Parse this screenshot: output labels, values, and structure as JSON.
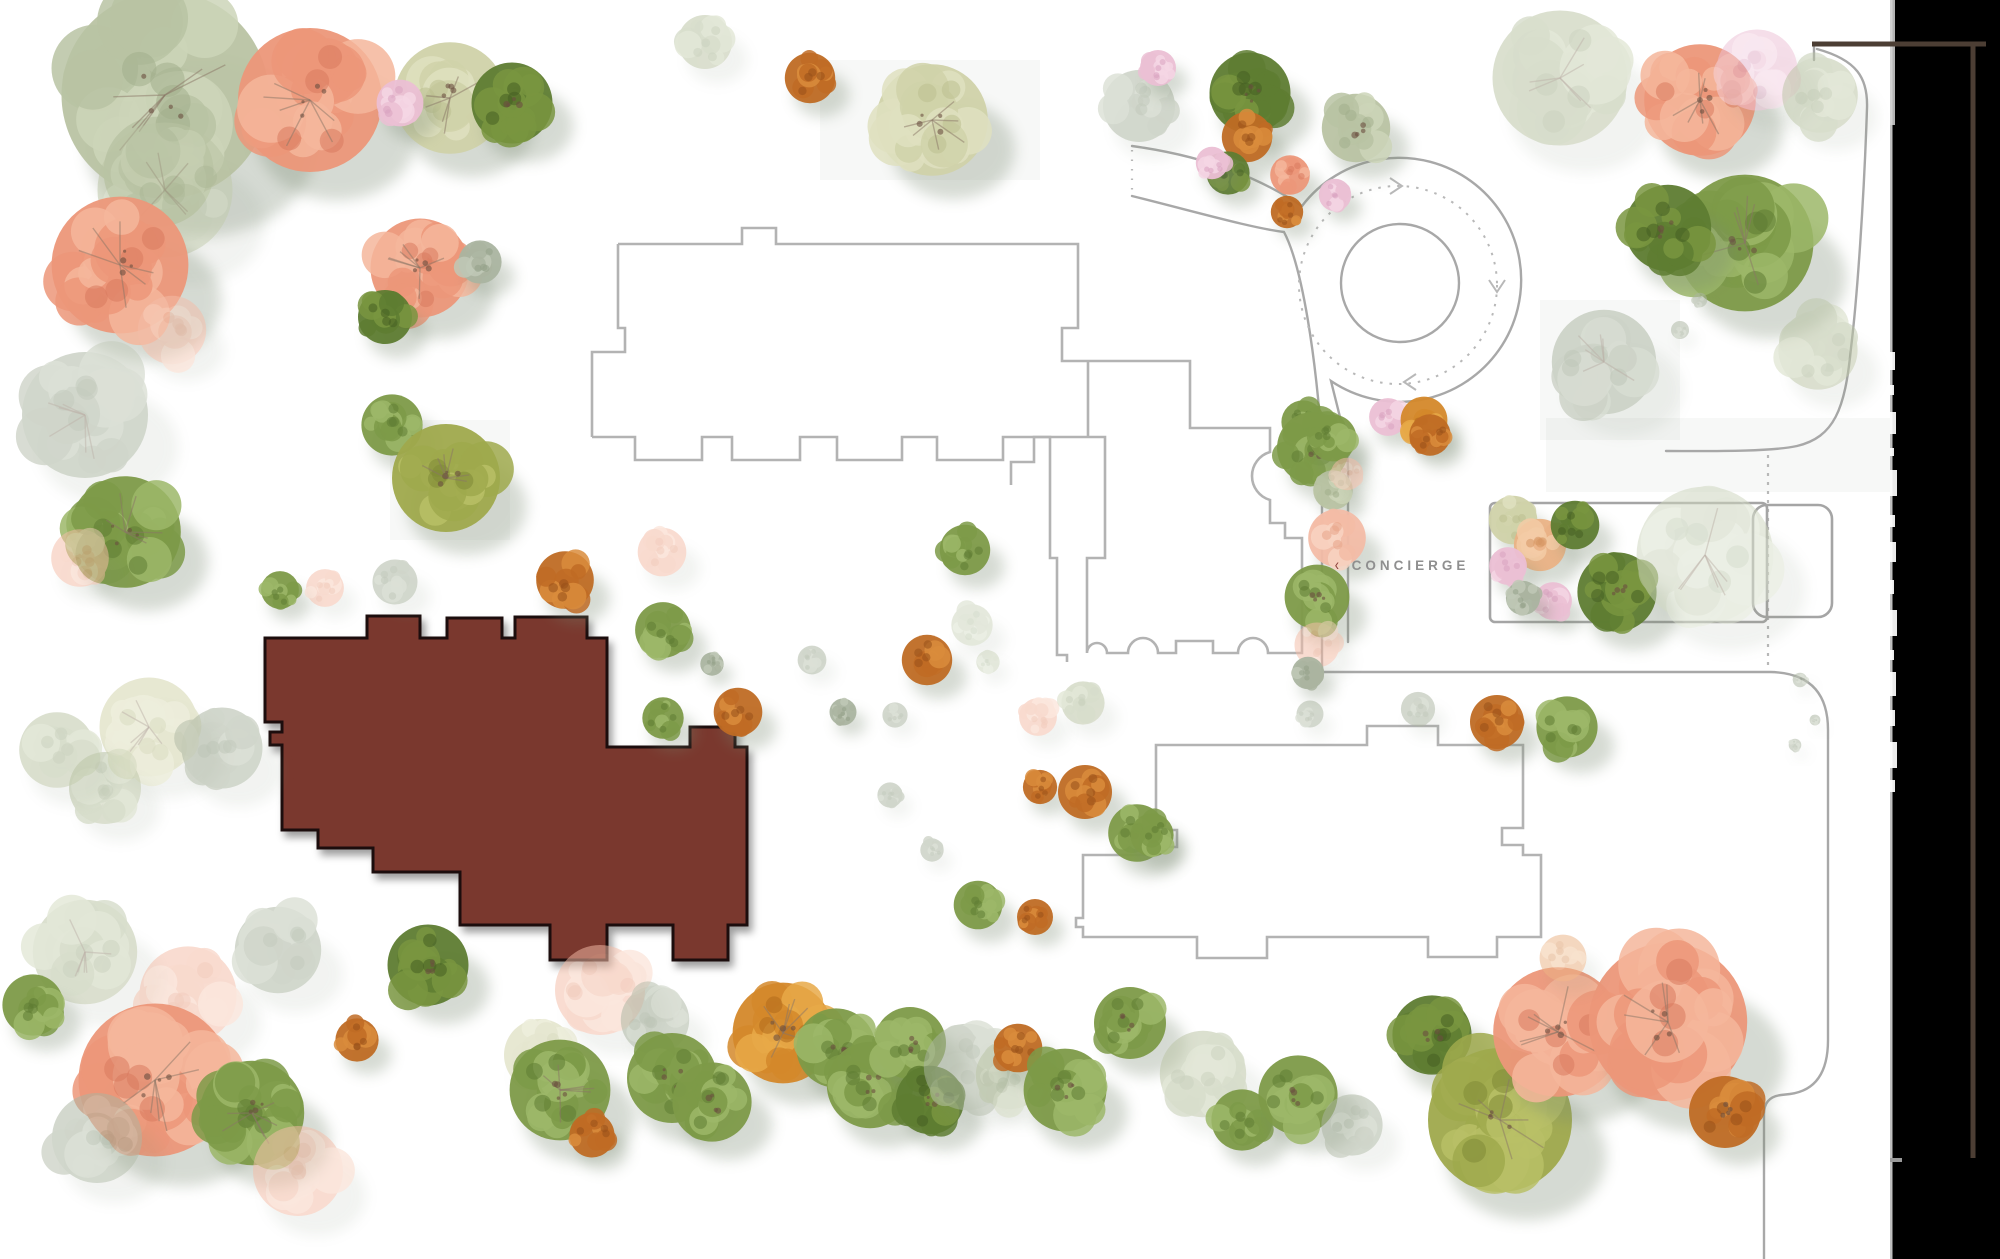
{
  "page": {
    "width": 2000,
    "height": 1259,
    "background": "#ffffff"
  },
  "concierge": {
    "chevron": "‹",
    "label": "CONCIERGE"
  },
  "palette": {
    "salmon": [
      "#ec9779",
      "#f5b69b",
      "#d87a5e"
    ],
    "salmonfade": [
      "#f3bca6",
      "#f8d4c2",
      "#e8a488"
    ],
    "sage": [
      "#b9c3a3",
      "#cdd5b9",
      "#a3af8c"
    ],
    "palegreen": [
      "#d0d2a9",
      "#dfe0bf",
      "#bcbf8f"
    ],
    "green": [
      "#7d9a48",
      "#9cb768",
      "#5f7c33"
    ],
    "darkgreen": [
      "#5e7c31",
      "#79953f",
      "#465f22"
    ],
    "olive": [
      "#9fa94c",
      "#b8bf66",
      "#7f8a36"
    ],
    "rust": [
      "#bf6b24",
      "#d98c3c",
      "#97511a"
    ],
    "orange": [
      "#d4882a",
      "#e8a948",
      "#b06a1c"
    ],
    "peach": [
      "#eab285",
      "#f3cba6",
      "#d69663"
    ],
    "pink": [
      "#ebbfd4",
      "#f4d6e4",
      "#d9a3bf"
    ],
    "graygreen": [
      "#aab4a0",
      "#bfc8b6",
      "#93a088"
    ],
    "mintfade": [
      "#ccd5bd",
      "#dce3d0",
      "#b7c2a8"
    ]
  },
  "shadow": {
    "color": "#78886f",
    "branch": "#8a7666"
  },
  "highlight_building": {
    "fill": "#7a382d",
    "stroke": "#1c0d08",
    "path": "M 265,638 L 367,638 L 367,616 L 420,616 L 420,638 L 447,638 L 447,618 L 502,618 L 502,638 L 515,638 L 515,617 L 587,617 L 587,638 L 607,638 L 607,747 L 690,747 L 690,727 L 735,727 L 735,747 L 747,747 L 747,925 L 728,925 L 728,960 L 673,960 L 673,925 L 607,925 L 607,960 L 550,960 L 550,925 L 460,925 L 460,872 L 373,872 L 373,848 L 318,848 L 318,830 L 282,830 L 282,745 L 270,745 L 270,732 L 282,732 L 282,722 L 265,722 Z"
  },
  "buildings": [
    {
      "name": "building-outline-north",
      "path": "M 618,244 L 742,244 L 742,228 L 776,228 L 776,244 L 1078,244 L 1078,328 L 1062,328 L 1062,361 L 1190,361 L 1190,428 L 1270,428 L 1270,452 A 25 25 0 0 0 1270,500 L 1270,523 L 1285,523 L 1285,538 L 1302,538 L 1302,653 L 1268,653 A 15 15 0 0 0 1238,653 L 1213,653 L 1213,641 L 1176,641 L 1176,653 L 1158,653 A 15 15 0 0 0 1128,653 L 1107,653 A 10 10 0 0 0 1087,653 L 1087,558 L 1105,558 L 1105,437 L 1034,437 L 1034,462 L 1011,462 L 1011,485"
    },
    {
      "name": "building-outline-north-left-edge",
      "path": "M 592,437 L 592,352 L 625,352 L 625,328 L 618,328 L 618,244"
    },
    {
      "name": "building-outline-north-crenellation",
      "path": "M 592,437 L 635,437 L 635,460 L 702,460 L 702,437 L 732,437 L 732,460 L 800,460 L 800,437 L 837,437 L 837,460 L 902,460 L 902,437 L 937,437 L 937,460 L 1003,460 L 1003,437 L 1050,437 L 1050,558 L 1057,558 L 1057,655 L 1067,655 L 1067,662"
    },
    {
      "name": "building-outline-link",
      "path": "M 1088,361 L 1088,437"
    },
    {
      "name": "building-outline-south",
      "path": "M 1156,745 L 1367,745 L 1367,726 L 1438,726 L 1438,745 L 1523,745 L 1523,828 L 1502,828 L 1502,845 L 1523,845 L 1523,855 L 1541,855 L 1541,937 L 1497,937 L 1497,957 L 1428,957 L 1428,937 L 1267,937 L 1267,958 L 1197,958 L 1197,937 L 1083,937 L 1083,927 L 1076,927 L 1076,918 L 1083,918 L 1083,855 L 1156,855 L 1156,847 L 1177,847 L 1177,830 L 1156,830 Z"
    }
  ],
  "roads": [
    {
      "name": "entry-road-north-edge",
      "path": "M 1132,146 C 1212,157 1264,181 1302,206"
    },
    {
      "name": "roundabout-outer-edge",
      "path": "M 1302,206 A 122 122 0 1 1 1331,381 C 1340,418 1347,440 1348,468 L 1348,642"
    },
    {
      "name": "entry-road-south-edge",
      "path": "M 1132,196 C 1200,213 1252,228 1284,232 C 1303,268 1316,360 1322,445 L 1322,672"
    },
    {
      "name": "south-loop-road",
      "path": "M 1322,672 L 1770,672 Q 1828,673 1828,730 L 1828,1040 Q 1828,1089 1790,1094 L 1781,1095 Q 1764,1097 1764,1114 L 1764,1259"
    },
    {
      "name": "northeast-road",
      "path": "M 1817,49 C 1857,60 1868,78 1867,108 C 1864,200 1857,300 1851,348 C 1845,410 1834,437 1797,446 C 1770,452 1706,451 1666,451"
    },
    {
      "name": "northeast-road-tick",
      "path": "M 1814,44 L 1814,60"
    }
  ],
  "roundabout": {
    "cx": 1400,
    "cy": 283,
    "island_r": 59,
    "dashed_cx": 1398,
    "dashed_cy": 285,
    "dashed_r": 99
  },
  "arrows": [
    {
      "name": "flow-arrow-east",
      "points": "1390,178 1402,186 1390,194"
    },
    {
      "name": "flow-arrow-south",
      "points": "1489,280 1497,292 1505,280"
    },
    {
      "name": "flow-arrow-west",
      "points": "1416,374 1404,382 1416,390"
    }
  ],
  "dashed_lines": [
    {
      "name": "entry-dotted-tick",
      "path": "M 1132,150 L 1132,194",
      "dash": "1.5 8"
    },
    {
      "name": "boundary-dashed",
      "path": "M 1768,455 L 1768,668",
      "dash": "3 6"
    }
  ],
  "enclosures": [
    {
      "name": "concierge-court-large",
      "x": 1490,
      "y": 503,
      "w": 277,
      "h": 119,
      "rx": 5
    },
    {
      "name": "concierge-court-small",
      "x": 1753,
      "y": 505,
      "w": 79,
      "h": 112,
      "rx": 14
    }
  ],
  "plates": [
    [
      1546,
      418,
      344,
      74
    ],
    [
      390,
      420,
      120,
      120
    ],
    [
      1540,
      300,
      140,
      140
    ],
    [
      820,
      60,
      220,
      120
    ]
  ],
  "right_panel": {
    "x": 1890,
    "w": 110,
    "color": "#000000",
    "strip_color": "#d4d4d4",
    "fragments": [
      [
        352,
        18,
        5
      ],
      [
        385,
        10,
        4
      ],
      [
        412,
        22,
        6
      ],
      [
        448,
        8,
        4
      ],
      [
        470,
        26,
        7
      ],
      [
        515,
        12,
        5
      ],
      [
        542,
        20,
        6
      ],
      [
        580,
        14,
        4
      ],
      [
        610,
        26,
        7
      ],
      [
        650,
        10,
        4
      ],
      [
        672,
        24,
        6
      ],
      [
        710,
        16,
        5
      ],
      [
        742,
        26,
        7
      ],
      [
        780,
        12,
        5
      ]
    ],
    "top_strip": {
      "y": 0,
      "h": 125,
      "w": 5
    },
    "bottom_dash": {
      "y": 1158,
      "w": 12,
      "h": 4,
      "color": "#9a9a9a"
    },
    "brown": {
      "color": "#4c3e34",
      "h_line": "M 1812,44 L 1986,44",
      "v_line": "M 1973,46 L 1973,1158"
    }
  },
  "trees": [
    [
      165,
      95,
      115,
      "sage"
    ],
    [
      310,
      100,
      80,
      "salmon"
    ],
    [
      450,
      98,
      62,
      "palegreen"
    ],
    [
      400,
      103,
      26,
      "pink"
    ],
    [
      512,
      103,
      45,
      "darkgreen"
    ],
    [
      165,
      190,
      75,
      "sage",
      1
    ],
    [
      120,
      265,
      76,
      "salmon"
    ],
    [
      172,
      330,
      38,
      "salmonfade",
      1
    ],
    [
      85,
      415,
      70,
      "graygreen",
      1
    ],
    [
      125,
      532,
      62,
      "green"
    ],
    [
      80,
      558,
      32,
      "salmonfade",
      1
    ],
    [
      420,
      268,
      55,
      "salmon"
    ],
    [
      480,
      262,
      24,
      "graygreen"
    ],
    [
      385,
      317,
      30,
      "darkgreen"
    ],
    [
      392,
      425,
      34,
      "green"
    ],
    [
      446,
      478,
      60,
      "olive"
    ],
    [
      705,
      42,
      30,
      "sage",
      1
    ],
    [
      810,
      78,
      28,
      "rust"
    ],
    [
      932,
      120,
      62,
      "palegreen"
    ],
    [
      1139,
      106,
      40,
      "graygreen",
      1
    ],
    [
      1158,
      68,
      20,
      "pink"
    ],
    [
      1250,
      93,
      45,
      "darkgreen"
    ],
    [
      1247,
      137,
      28,
      "rust"
    ],
    [
      1228,
      173,
      24,
      "darkgreen"
    ],
    [
      1212,
      163,
      18,
      "pink"
    ],
    [
      1290,
      175,
      22,
      "salmon"
    ],
    [
      1335,
      195,
      18,
      "pink"
    ],
    [
      1287,
      212,
      18,
      "rust"
    ],
    [
      1356,
      128,
      38,
      "sage"
    ],
    [
      1560,
      78,
      75,
      "sage",
      1
    ],
    [
      1700,
      100,
      62,
      "salmon"
    ],
    [
      1757,
      70,
      45,
      "pink",
      1
    ],
    [
      1820,
      95,
      42,
      "sage",
      1
    ],
    [
      1745,
      243,
      76,
      "green"
    ],
    [
      1668,
      228,
      48,
      "darkgreen"
    ],
    [
      1604,
      362,
      58,
      "graygreen",
      1
    ],
    [
      1818,
      350,
      44,
      "sage",
      1
    ],
    [
      1680,
      330,
      10,
      "graygreen",
      1
    ],
    [
      1700,
      300,
      8,
      "graygreen",
      1
    ],
    [
      1303,
      422,
      24,
      "green"
    ],
    [
      1388,
      417,
      21,
      "pink"
    ],
    [
      1424,
      420,
      26,
      "orange"
    ],
    [
      1313,
      448,
      40,
      "green"
    ],
    [
      1333,
      490,
      22,
      "sage"
    ],
    [
      1337,
      538,
      32,
      "salmonfade"
    ],
    [
      1317,
      597,
      36,
      "green"
    ],
    [
      1317,
      645,
      25,
      "salmonfade",
      1
    ],
    [
      1308,
      673,
      18,
      "graygreen"
    ],
    [
      1513,
      520,
      27,
      "palegreen"
    ],
    [
      1540,
      545,
      29,
      "peach"
    ],
    [
      1508,
      566,
      21,
      "pink"
    ],
    [
      1553,
      601,
      21,
      "pink"
    ],
    [
      1523,
      598,
      19,
      "graygreen"
    ],
    [
      1575,
      525,
      27,
      "darkgreen"
    ],
    [
      1617,
      592,
      44,
      "darkgreen"
    ],
    [
      1705,
      555,
      76,
      "mintfade",
      1
    ],
    [
      1333,
      438,
      26,
      "green"
    ],
    [
      1430,
      435,
      23,
      "rust"
    ],
    [
      1347,
      474,
      18,
      "salmonfade",
      1
    ],
    [
      565,
      580,
      32,
      "rust"
    ],
    [
      662,
      552,
      27,
      "salmonfade",
      1
    ],
    [
      663,
      630,
      31,
      "green"
    ],
    [
      712,
      664,
      13,
      "graygreen"
    ],
    [
      663,
      718,
      23,
      "green"
    ],
    [
      738,
      712,
      27,
      "rust"
    ],
    [
      812,
      660,
      16,
      "graygreen",
      1
    ],
    [
      843,
      712,
      15,
      "graygreen"
    ],
    [
      895,
      715,
      14,
      "graygreen",
      1
    ],
    [
      965,
      550,
      28,
      "green"
    ],
    [
      972,
      625,
      23,
      "mintfade",
      1
    ],
    [
      988,
      662,
      13,
      "mintfade",
      1
    ],
    [
      927,
      660,
      28,
      "rust"
    ],
    [
      1038,
      717,
      21,
      "salmonfade",
      1
    ],
    [
      1040,
      787,
      19,
      "rust"
    ],
    [
      890,
      795,
      14,
      "graygreen",
      1
    ],
    [
      932,
      850,
      13,
      "graygreen",
      1
    ],
    [
      1083,
      703,
      24,
      "sage",
      1
    ],
    [
      1310,
      714,
      15,
      "graygreen",
      1
    ],
    [
      1418,
      709,
      19,
      "graygreen",
      1
    ],
    [
      1497,
      722,
      30,
      "rust"
    ],
    [
      1567,
      727,
      34,
      "green"
    ],
    [
      1085,
      792,
      30,
      "rust"
    ],
    [
      1137,
      833,
      32,
      "green"
    ],
    [
      1152,
      835,
      24,
      "green"
    ],
    [
      978,
      905,
      27,
      "green"
    ],
    [
      1035,
      917,
      20,
      "rust"
    ],
    [
      149,
      727,
      55,
      "palegreen",
      1
    ],
    [
      222,
      748,
      45,
      "graygreen",
      1
    ],
    [
      105,
      788,
      40,
      "sage",
      1
    ],
    [
      57,
      750,
      42,
      "sage",
      1
    ],
    [
      280,
      590,
      21,
      "green"
    ],
    [
      325,
      588,
      21,
      "salmonfade",
      1
    ],
    [
      395,
      582,
      25,
      "graygreen",
      1
    ],
    [
      85,
      952,
      58,
      "sage",
      1
    ],
    [
      188,
      995,
      54,
      "salmonfade",
      1
    ],
    [
      278,
      950,
      48,
      "graygreen",
      1
    ],
    [
      155,
      1080,
      85,
      "salmon"
    ],
    [
      252,
      1113,
      58,
      "green"
    ],
    [
      97,
      1138,
      50,
      "graygreen",
      1
    ],
    [
      298,
      1171,
      50,
      "salmonfade",
      1
    ],
    [
      428,
      965,
      45,
      "darkgreen"
    ],
    [
      357,
      1040,
      24,
      "rust"
    ],
    [
      33,
      1005,
      34,
      "green"
    ],
    [
      540,
      1055,
      40,
      "palegreen",
      1
    ],
    [
      560,
      1090,
      56,
      "green"
    ],
    [
      592,
      1135,
      25,
      "rust"
    ],
    [
      600,
      990,
      50,
      "salmonfade",
      1
    ],
    [
      655,
      1020,
      38,
      "graygreen",
      1
    ],
    [
      672,
      1078,
      50,
      "green"
    ],
    [
      712,
      1102,
      44,
      "green"
    ],
    [
      783,
      1033,
      56,
      "orange"
    ],
    [
      836,
      1048,
      44,
      "green"
    ],
    [
      870,
      1085,
      48,
      "green"
    ],
    [
      910,
      1043,
      40,
      "green"
    ],
    [
      930,
      1100,
      38,
      "darkgreen"
    ],
    [
      967,
      1067,
      48,
      "graygreen",
      1
    ],
    [
      1010,
      1075,
      38,
      "sage",
      1
    ],
    [
      1018,
      1048,
      27,
      "rust"
    ],
    [
      1065,
      1090,
      46,
      "green"
    ],
    [
      1130,
      1023,
      40,
      "green"
    ],
    [
      1203,
      1074,
      48,
      "sage",
      1
    ],
    [
      1242,
      1120,
      34,
      "green"
    ],
    [
      1298,
      1095,
      44,
      "green"
    ],
    [
      1352,
      1125,
      34,
      "graygreen",
      1
    ],
    [
      1432,
      1035,
      44,
      "darkgreen"
    ],
    [
      1500,
      1120,
      80,
      "olive"
    ],
    [
      1558,
      1032,
      72,
      "salmon"
    ],
    [
      1668,
      1022,
      88,
      "salmon"
    ],
    [
      1725,
      1112,
      40,
      "rust"
    ],
    [
      1563,
      958,
      26,
      "peach",
      1
    ],
    [
      1800,
      680,
      8,
      "graygreen",
      1
    ],
    [
      1815,
      720,
      6,
      "graygreen",
      1
    ],
    [
      1795,
      745,
      7,
      "graygreen",
      1
    ]
  ],
  "style": {
    "road_stroke": "#a8a8a8",
    "building_stroke": "#b3b3b3",
    "dash_stroke": "#b8b8b8",
    "plate_fill": "#9aa695"
  }
}
